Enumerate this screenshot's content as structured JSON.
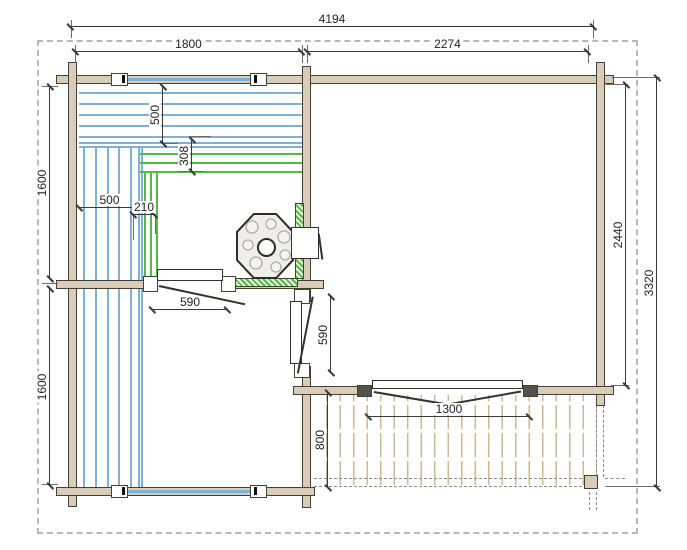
{
  "drawing": {
    "title": "log cabin sauna floor plan",
    "dims": {
      "overall_width": "4194",
      "sauna_width": "1800",
      "lounge_width": "2274",
      "left_upper_height": "1600",
      "left_lower_height": "1600",
      "lounge_inner_height": "2440",
      "overall_height": "3320",
      "bench_top_depth": "500",
      "bench_step_depth": "308",
      "bench_side_width": "500",
      "bench_step_width": "210",
      "sauna_door_width": "590",
      "room_door_width": "590",
      "terrace_door_width": "1300",
      "terrace_depth": "800"
    },
    "colors": {
      "wall_fill": "#d9ccb8",
      "outline": "#454036",
      "bench_blue": "#7fb0d6",
      "step_green": "#55b944",
      "terrace_plank": "#cfb88f",
      "dimension_line": "#3a3a3a",
      "boundary_dash": "#b7b7b7"
    }
  }
}
